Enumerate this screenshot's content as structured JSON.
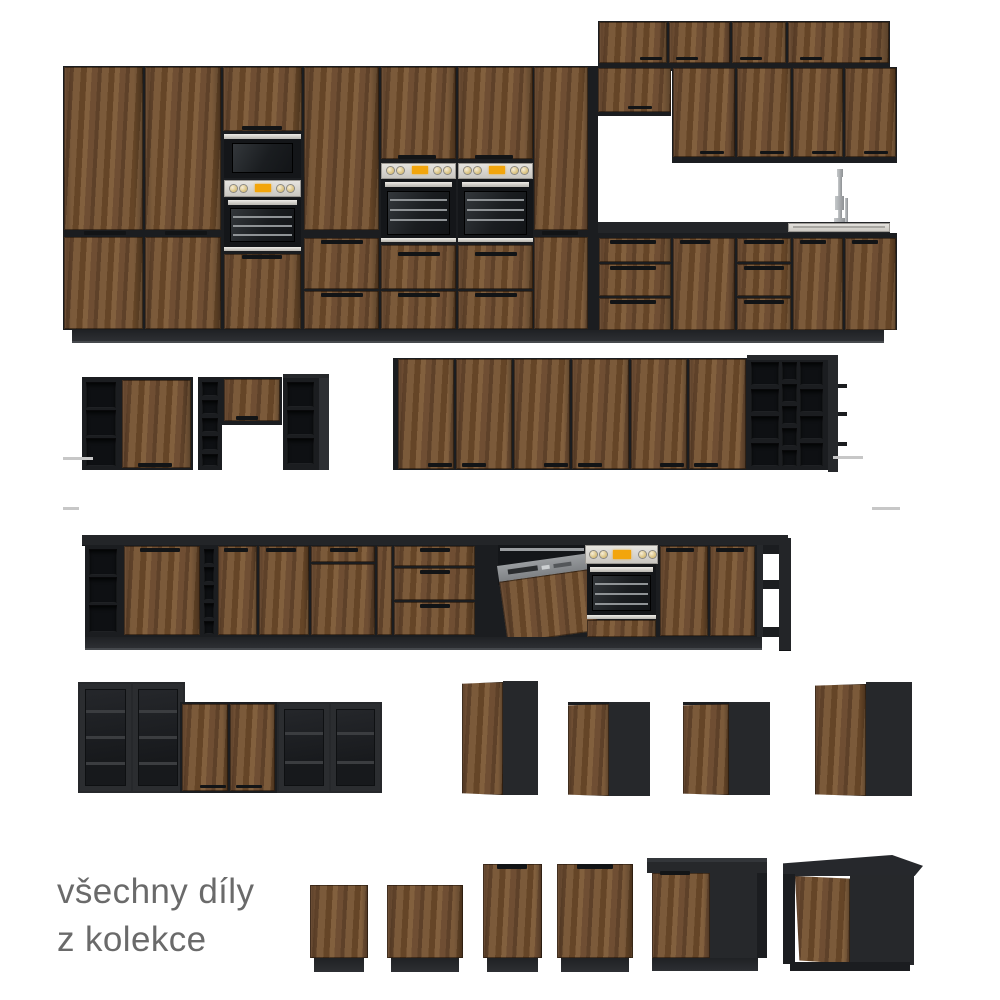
{
  "caption": {
    "line1": "všechny díly",
    "line2": "z kolekce"
  },
  "colors": {
    "background": "#FFFFFF",
    "wood_mid": "#6F4E33",
    "wood_dark": "#5E4129",
    "wood_light": "#82603E",
    "carcass_black": "#1B1D20",
    "panel_dark": "#26282B",
    "countertop": "#232528",
    "steel": "#E8E6E1",
    "oven_black": "#141619",
    "display_orange": "#F2A50C",
    "caption_gray": "#6A6A6A",
    "rail_gray": "#C7C7C7"
  }
}
